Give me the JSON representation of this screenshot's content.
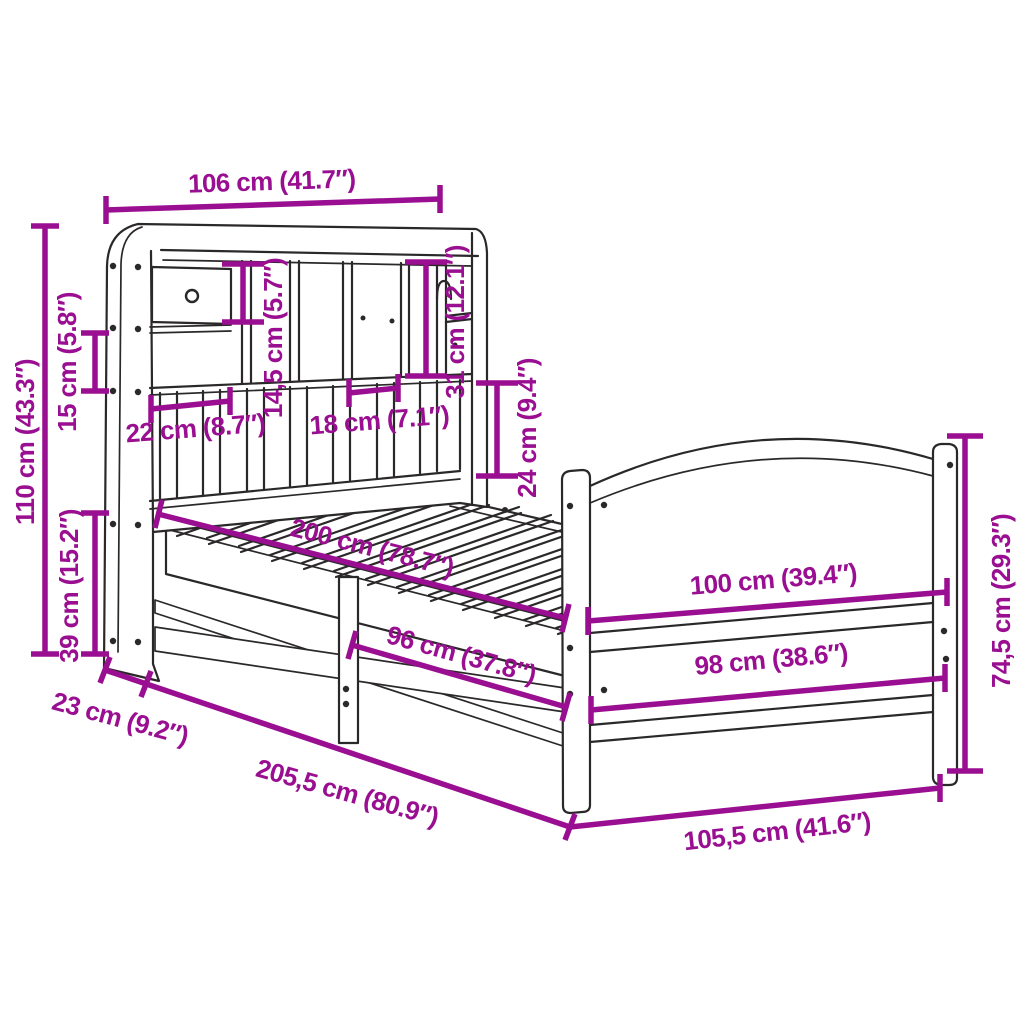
{
  "diagram": {
    "title": "Bed frame with bookcase headboard - dimension diagram",
    "unit_system": "cm (inches)",
    "accent_color": "#9A0E91",
    "line_color": "#2B282A",
    "background_color": "#FFFFFF",
    "dimensions": [
      {
        "id": "headboard-top-width",
        "label": "106 cm (41.7″)"
      },
      {
        "id": "headboard-height",
        "label": "110 cm (43.3″)"
      },
      {
        "id": "side-shelf-opening-height",
        "label": "15 cm (5.8″)"
      },
      {
        "id": "drawer-compartment-height",
        "label": "14,5 cm (5.7″)"
      },
      {
        "id": "tall-compartment-height",
        "label": "31 cm (12.1″)"
      },
      {
        "id": "left-compartment-width",
        "label": "22 cm (8.7″)"
      },
      {
        "id": "right-compartment-width",
        "label": "18 cm (7.1″)"
      },
      {
        "id": "lower-panel-height",
        "label": "24 cm (9.4″)"
      },
      {
        "id": "under-bed-clearance",
        "label": "39 cm (15.2″)"
      },
      {
        "id": "mattress-length",
        "label": "200 cm (78.7″)"
      },
      {
        "id": "side-rail-length",
        "label": "96 cm (37.8″)"
      },
      {
        "id": "footboard-width",
        "label": "100 cm (39.4″)"
      },
      {
        "id": "footboard-inner-width",
        "label": "98 cm (38.6″)"
      },
      {
        "id": "footboard-height",
        "label": "74,5 cm (29.3″)"
      },
      {
        "id": "headboard-depth",
        "label": "23 cm (9.2″)"
      },
      {
        "id": "total-length",
        "label": "205,5 cm (80.9″)"
      },
      {
        "id": "total-width",
        "label": "105,5 cm (41.6″)"
      }
    ]
  }
}
